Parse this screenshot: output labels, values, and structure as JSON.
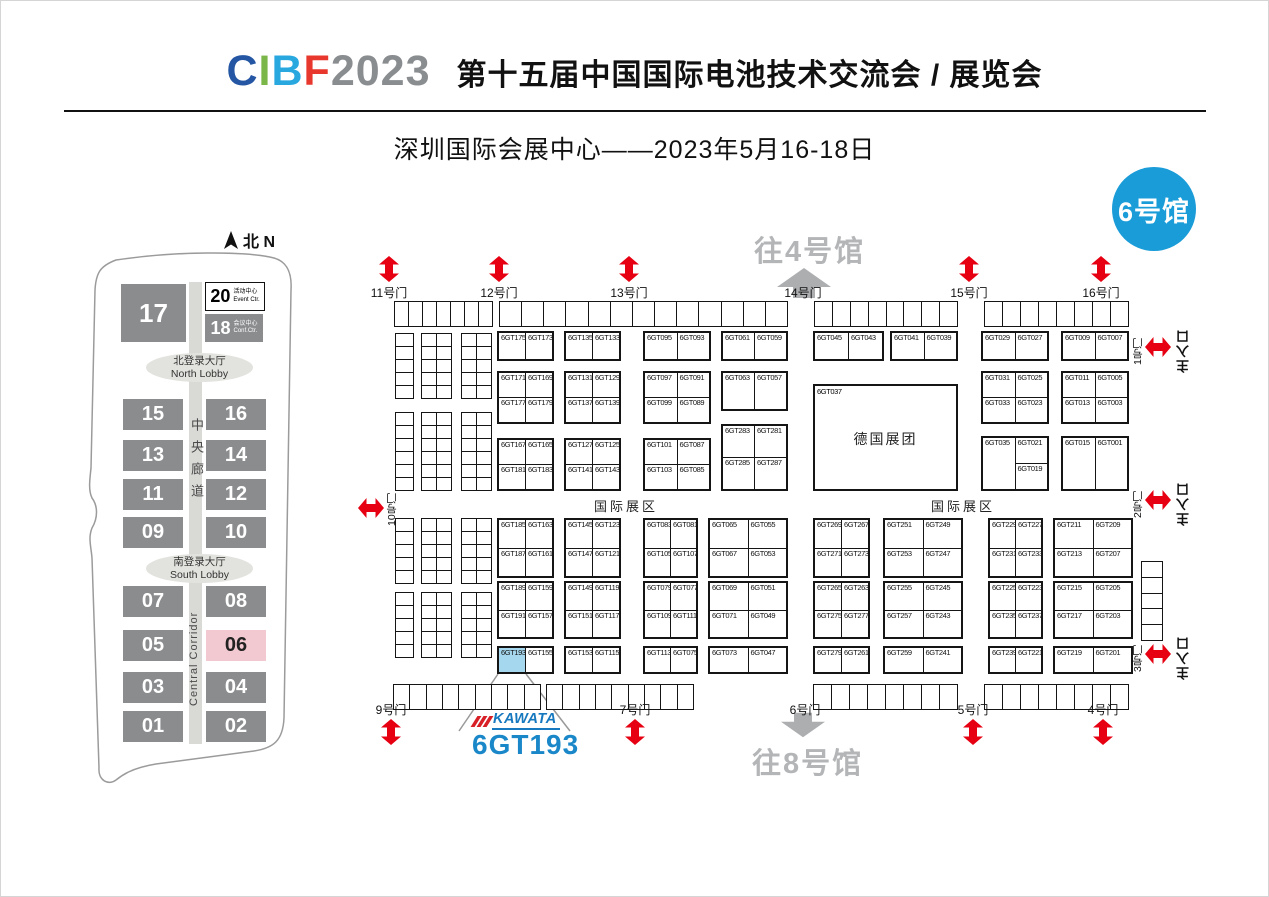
{
  "header": {
    "logo_letters": [
      {
        "text": "C",
        "color": "#2456a4"
      },
      {
        "text": "I",
        "color": "#7ab648"
      },
      {
        "text": "B",
        "color": "#29a8e0"
      },
      {
        "text": "F",
        "color": "#e8382d"
      },
      {
        "text": "2023",
        "color": "#8a8d90"
      }
    ],
    "title": "第十五届中国国际电池技术交流会 / 展览会",
    "subtitle": "深圳国际会展中心——2023年5月16-18日"
  },
  "hall_badge": "6号馆",
  "overview_map": {
    "compass_label": "北 N",
    "halls": [
      "17",
      "15",
      "16",
      "13",
      "14",
      "11",
      "12",
      "09",
      "10",
      "07",
      "08",
      "05",
      "06",
      "03",
      "04",
      "01",
      "02"
    ],
    "highlighted_hall": "06",
    "event_center": {
      "num": "20",
      "zh": "活动中心",
      "en": "Event Ctr."
    },
    "conference_center": {
      "num": "18",
      "zh": "会议中心",
      "en": "Conf.Ctr."
    },
    "north_lobby_zh": "北登录大厅",
    "north_lobby_en": "North Lobby",
    "south_lobby_zh": "南登录大厅",
    "south_lobby_en": "South Lobby",
    "corridor_zh": "中央廊道",
    "corridor_en": "Central Corridor"
  },
  "floor_plan": {
    "doors_top": [
      "11号门",
      "12号门",
      "13号门",
      "14号门",
      "15号门",
      "16号门"
    ],
    "doors_bottom": [
      "9号门",
      "7号门",
      "6号门",
      "5号门",
      "4号门"
    ],
    "doors_right": [
      "1号门",
      "2号门",
      "3号门"
    ],
    "door_left": "10号门",
    "main_entrance": "主入口",
    "to_hall_4": "往4号馆",
    "to_hall_8": "往8号馆",
    "international_zone": "国际展区",
    "pavilion": {
      "booth": "6GT037",
      "name": "德国展团"
    },
    "highlight": {
      "booth": "6GT193",
      "brand": "KAWATA"
    },
    "blocks": {
      "t1": [
        [
          "6GT175",
          "6GT173"
        ]
      ],
      "t2": [
        [
          "6GT135",
          "6GT133"
        ]
      ],
      "t3": [
        [
          "6GT095",
          "6GT093"
        ]
      ],
      "t4": [
        [
          "6GT061",
          "6GT059"
        ]
      ],
      "t5": [
        [
          "6GT045",
          "6GT043"
        ]
      ],
      "t6": [
        [
          "6GT041",
          "6GT039"
        ]
      ],
      "t7": [
        [
          "6GT029",
          "6GT027"
        ]
      ],
      "t8": [
        [
          "6GT009",
          "6GT007"
        ]
      ],
      "t9": [
        [
          "6GT171",
          "6GT169"
        ],
        [
          "6GT177",
          "6GT179"
        ]
      ],
      "t10": [
        [
          "6GT131",
          "6GT129"
        ],
        [
          "6GT137",
          "6GT139"
        ]
      ],
      "t11": [
        [
          "6GT097",
          "6GT091"
        ],
        [
          "6GT099",
          "6GT089"
        ]
      ],
      "t12": [
        [
          "6GT063",
          "6GT057"
        ]
      ],
      "t13": [
        [
          "6GT031",
          "6GT025"
        ],
        [
          "6GT033",
          "6GT023"
        ]
      ],
      "t14": [
        [
          "6GT011",
          "6GT005"
        ],
        [
          "6GT013",
          "6GT003"
        ]
      ],
      "t15": [
        [
          "6GT167",
          "6GT165"
        ],
        [
          "6GT181",
          "6GT183"
        ]
      ],
      "t16": [
        [
          "6GT127",
          "6GT125"
        ],
        [
          "6GT141",
          "6GT143"
        ]
      ],
      "t17": [
        [
          "6GT101",
          "6GT087"
        ],
        [
          "6GT103",
          "6GT085"
        ]
      ],
      "t18": [
        [
          "6GT283",
          "6GT281"
        ],
        [
          "6GT285",
          "6GT287"
        ]
      ],
      "t19": [
        [
          "6GT035",
          "6GT021"
        ],
        [
          "6GT019"
        ]
      ],
      "t20": [
        [
          "6GT015",
          "6GT001"
        ]
      ],
      "b1": [
        [
          "6GT185",
          "6GT163"
        ],
        [
          "6GT187",
          "6GT161"
        ]
      ],
      "b2": [
        [
          "6GT145",
          "6GT123"
        ],
        [
          "6GT147",
          "6GT121"
        ]
      ],
      "b3": [
        [
          "6GT083",
          "6GT081"
        ],
        [
          "6GT105",
          "6GT107"
        ]
      ],
      "b4": [
        [
          "6GT065",
          "6GT055"
        ],
        [
          "6GT067",
          "6GT053"
        ]
      ],
      "b5": [
        [
          "6GT269",
          "6GT267"
        ],
        [
          "6GT271",
          "6GT273"
        ]
      ],
      "b6": [
        [
          "6GT251",
          "6GT249"
        ],
        [
          "6GT253",
          "6GT247"
        ]
      ],
      "b7": [
        [
          "6GT229",
          "6GT227"
        ],
        [
          "6GT231",
          "6GT233"
        ]
      ],
      "b8": [
        [
          "6GT211",
          "6GT209"
        ],
        [
          "6GT213",
          "6GT207"
        ]
      ],
      "b9": [
        [
          "6GT189",
          "6GT159"
        ],
        [
          "6GT191",
          "6GT157"
        ]
      ],
      "b10": [
        [
          "6GT149",
          "6GT119"
        ],
        [
          "6GT151",
          "6GT117"
        ]
      ],
      "b11": [
        [
          "6GT079",
          "6GT077"
        ],
        [
          "6GT109",
          "6GT111"
        ]
      ],
      "b12": [
        [
          "6GT069",
          "6GT051"
        ],
        [
          "6GT071",
          "6GT049"
        ]
      ],
      "b13": [
        [
          "6GT265",
          "6GT263"
        ],
        [
          "6GT275",
          "6GT277"
        ]
      ],
      "b14": [
        [
          "6GT255",
          "6GT245"
        ],
        [
          "6GT257",
          "6GT243"
        ]
      ],
      "b15": [
        [
          "6GT225",
          "6GT223"
        ],
        [
          "6GT235",
          "6GT237"
        ]
      ],
      "b16": [
        [
          "6GT215",
          "6GT205"
        ],
        [
          "6GT217",
          "6GT203"
        ]
      ],
      "b17": [
        [
          "6GT193",
          "6GT155"
        ]
      ],
      "b18": [
        [
          "6GT153",
          "6GT115"
        ]
      ],
      "b19": [
        [
          "6GT113",
          "6GT075"
        ]
      ],
      "b20": [
        [
          "6GT073",
          "6GT047"
        ]
      ],
      "b21": [
        [
          "6GT279",
          "6GT261"
        ]
      ],
      "b22": [
        [
          "6GT259",
          "6GT241"
        ]
      ],
      "b23": [
        [
          "6GT239",
          "6GT221"
        ]
      ],
      "b24": [
        [
          "6GT219",
          "6GT201"
        ]
      ]
    }
  },
  "colors": {
    "arrow_red": "#e60012",
    "arrow_gray": "#acaeb0",
    "badge_blue": "#1a9cd8",
    "highlight_booth": "#a5d7ee",
    "hall_gray": "#8a8c8e",
    "hall_pink": "#f2c9d0",
    "brand_blue": "#1678be"
  }
}
